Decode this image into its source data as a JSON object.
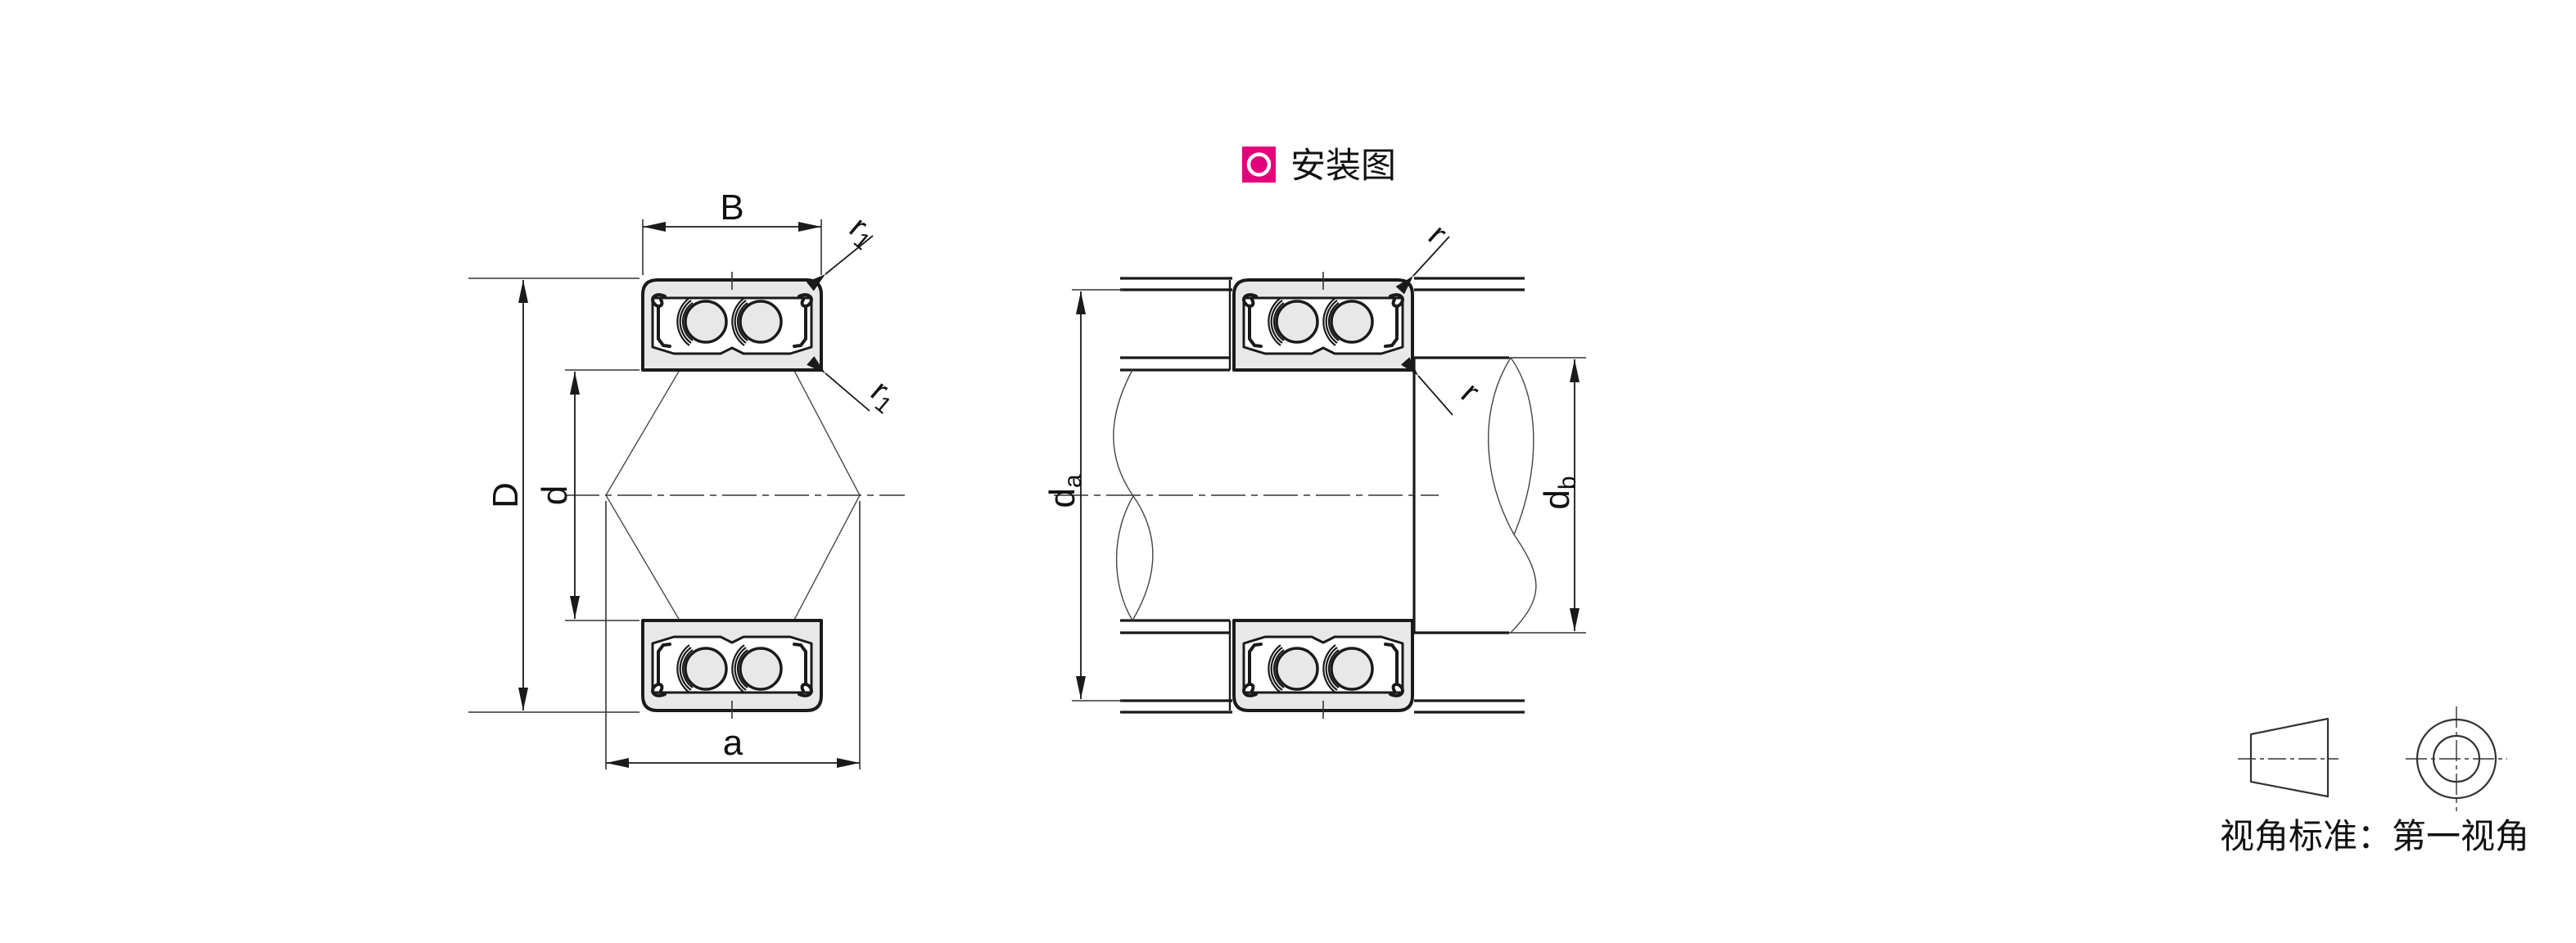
{
  "header": {
    "install_label": "安装图"
  },
  "cross_section": {
    "dim_B": "B",
    "dim_D": "D",
    "dim_d": "d",
    "dim_a": "a",
    "r1_main": "r",
    "r1_sub": "1"
  },
  "installation": {
    "da_main": "d",
    "da_sub": "a",
    "db_main": "d",
    "db_sub": "b",
    "dim_r": "r"
  },
  "projection": {
    "caption": "视角标准：第一视角"
  },
  "colors": {
    "accent_pink": "#e3007b",
    "line_dark": "#1a1a1a",
    "ring_fill": "#e8e8e8"
  }
}
